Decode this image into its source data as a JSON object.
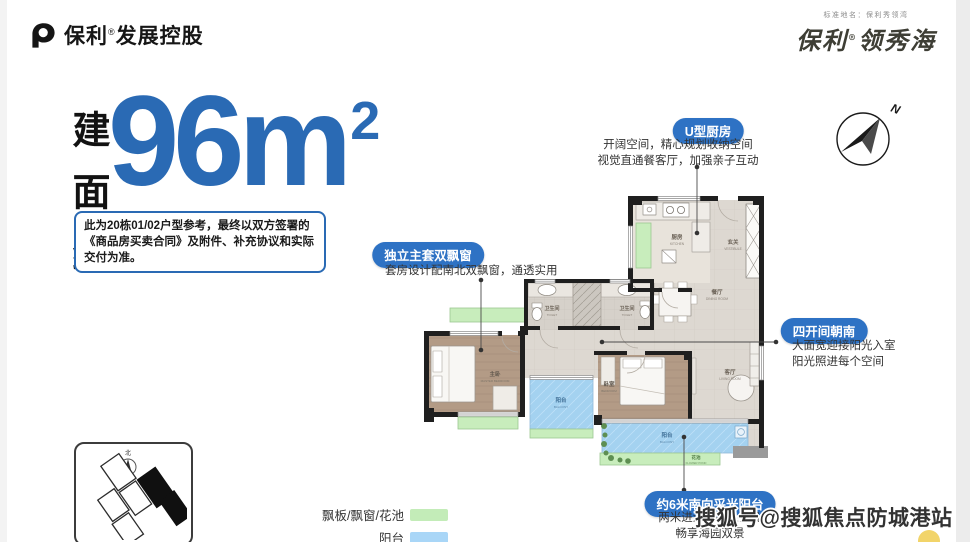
{
  "header": {
    "logo_brand": "保利",
    "logo_reg": "®",
    "logo_rest": "发展控股",
    "standard_name_note": "标准地名：保利秀领湾",
    "brand_script_left": "保利",
    "brand_script_reg": "®",
    "brand_script_right": "领秀海"
  },
  "area_badge": {
    "vertical_label": "建面约",
    "value": "96",
    "unit": "m",
    "sup": "2"
  },
  "disclaimer": "此为20栋01/02户型参考，最终以双方签署的《商品房买卖合同》及附件、补充协议和实际交付为准。",
  "callouts": {
    "kitchen": {
      "title": "U型厨房",
      "lines": [
        "开阔空间，精心规划收纳空间",
        "视觉直通餐客厅，加强亲子互动"
      ]
    },
    "master_suite": {
      "title": "独立主套双飘窗",
      "lines": [
        "套房设计配南北双飘窗，通透实用"
      ]
    },
    "south_rooms": {
      "title": "四开间朝南",
      "lines": [
        "大面宽迎接阳光入室",
        "阳光照进每个空间"
      ]
    },
    "south_balcony": {
      "title": "约6米南向采光阳台",
      "lines": [
        "两米进深，摆上茶几",
        "畅享海园双景"
      ]
    }
  },
  "floorplan": {
    "compass_label": "N",
    "rooms": {
      "kitchen": {
        "cn": "厨房",
        "en": "KITCHEN"
      },
      "vestibule": {
        "cn": "玄关",
        "en": "VESTIBULE"
      },
      "dining": {
        "cn": "餐厅",
        "en": "DINING ROOM"
      },
      "toilet1": {
        "cn": "卫生间",
        "en": "TOILET"
      },
      "toilet2": {
        "cn": "卫生间",
        "en": "TOILET"
      },
      "master": {
        "cn": "主卧",
        "en": "MASTER BEDROOM"
      },
      "balcony_north": {
        "cn": "阳台",
        "en": "BALCONY"
      },
      "bedroom2": {
        "cn": "卧室",
        "en": "BEDROOM"
      },
      "living": {
        "cn": "客厅",
        "en": "LIVING ROOM"
      },
      "balcony_south": {
        "cn": "阳台",
        "en": "BALCONY"
      },
      "flower_bed": {
        "cn": "花池",
        "en": "FLOWER POND"
      }
    }
  },
  "sitemap": {
    "north_label": "北"
  },
  "legend": {
    "items": [
      {
        "label": "飘板/飘窗/花池",
        "color": "#c3ecb8"
      },
      {
        "label": "阳台",
        "color": "#a9d6f7"
      }
    ]
  },
  "watermark": "搜狐号@搜狐焦点防城港站",
  "colors": {
    "accent_blue": "#2a6ab4",
    "pill_blue": "#2e72c4",
    "floor_green": "#c8edbc",
    "balcony_blue": "#a4d2f0"
  }
}
